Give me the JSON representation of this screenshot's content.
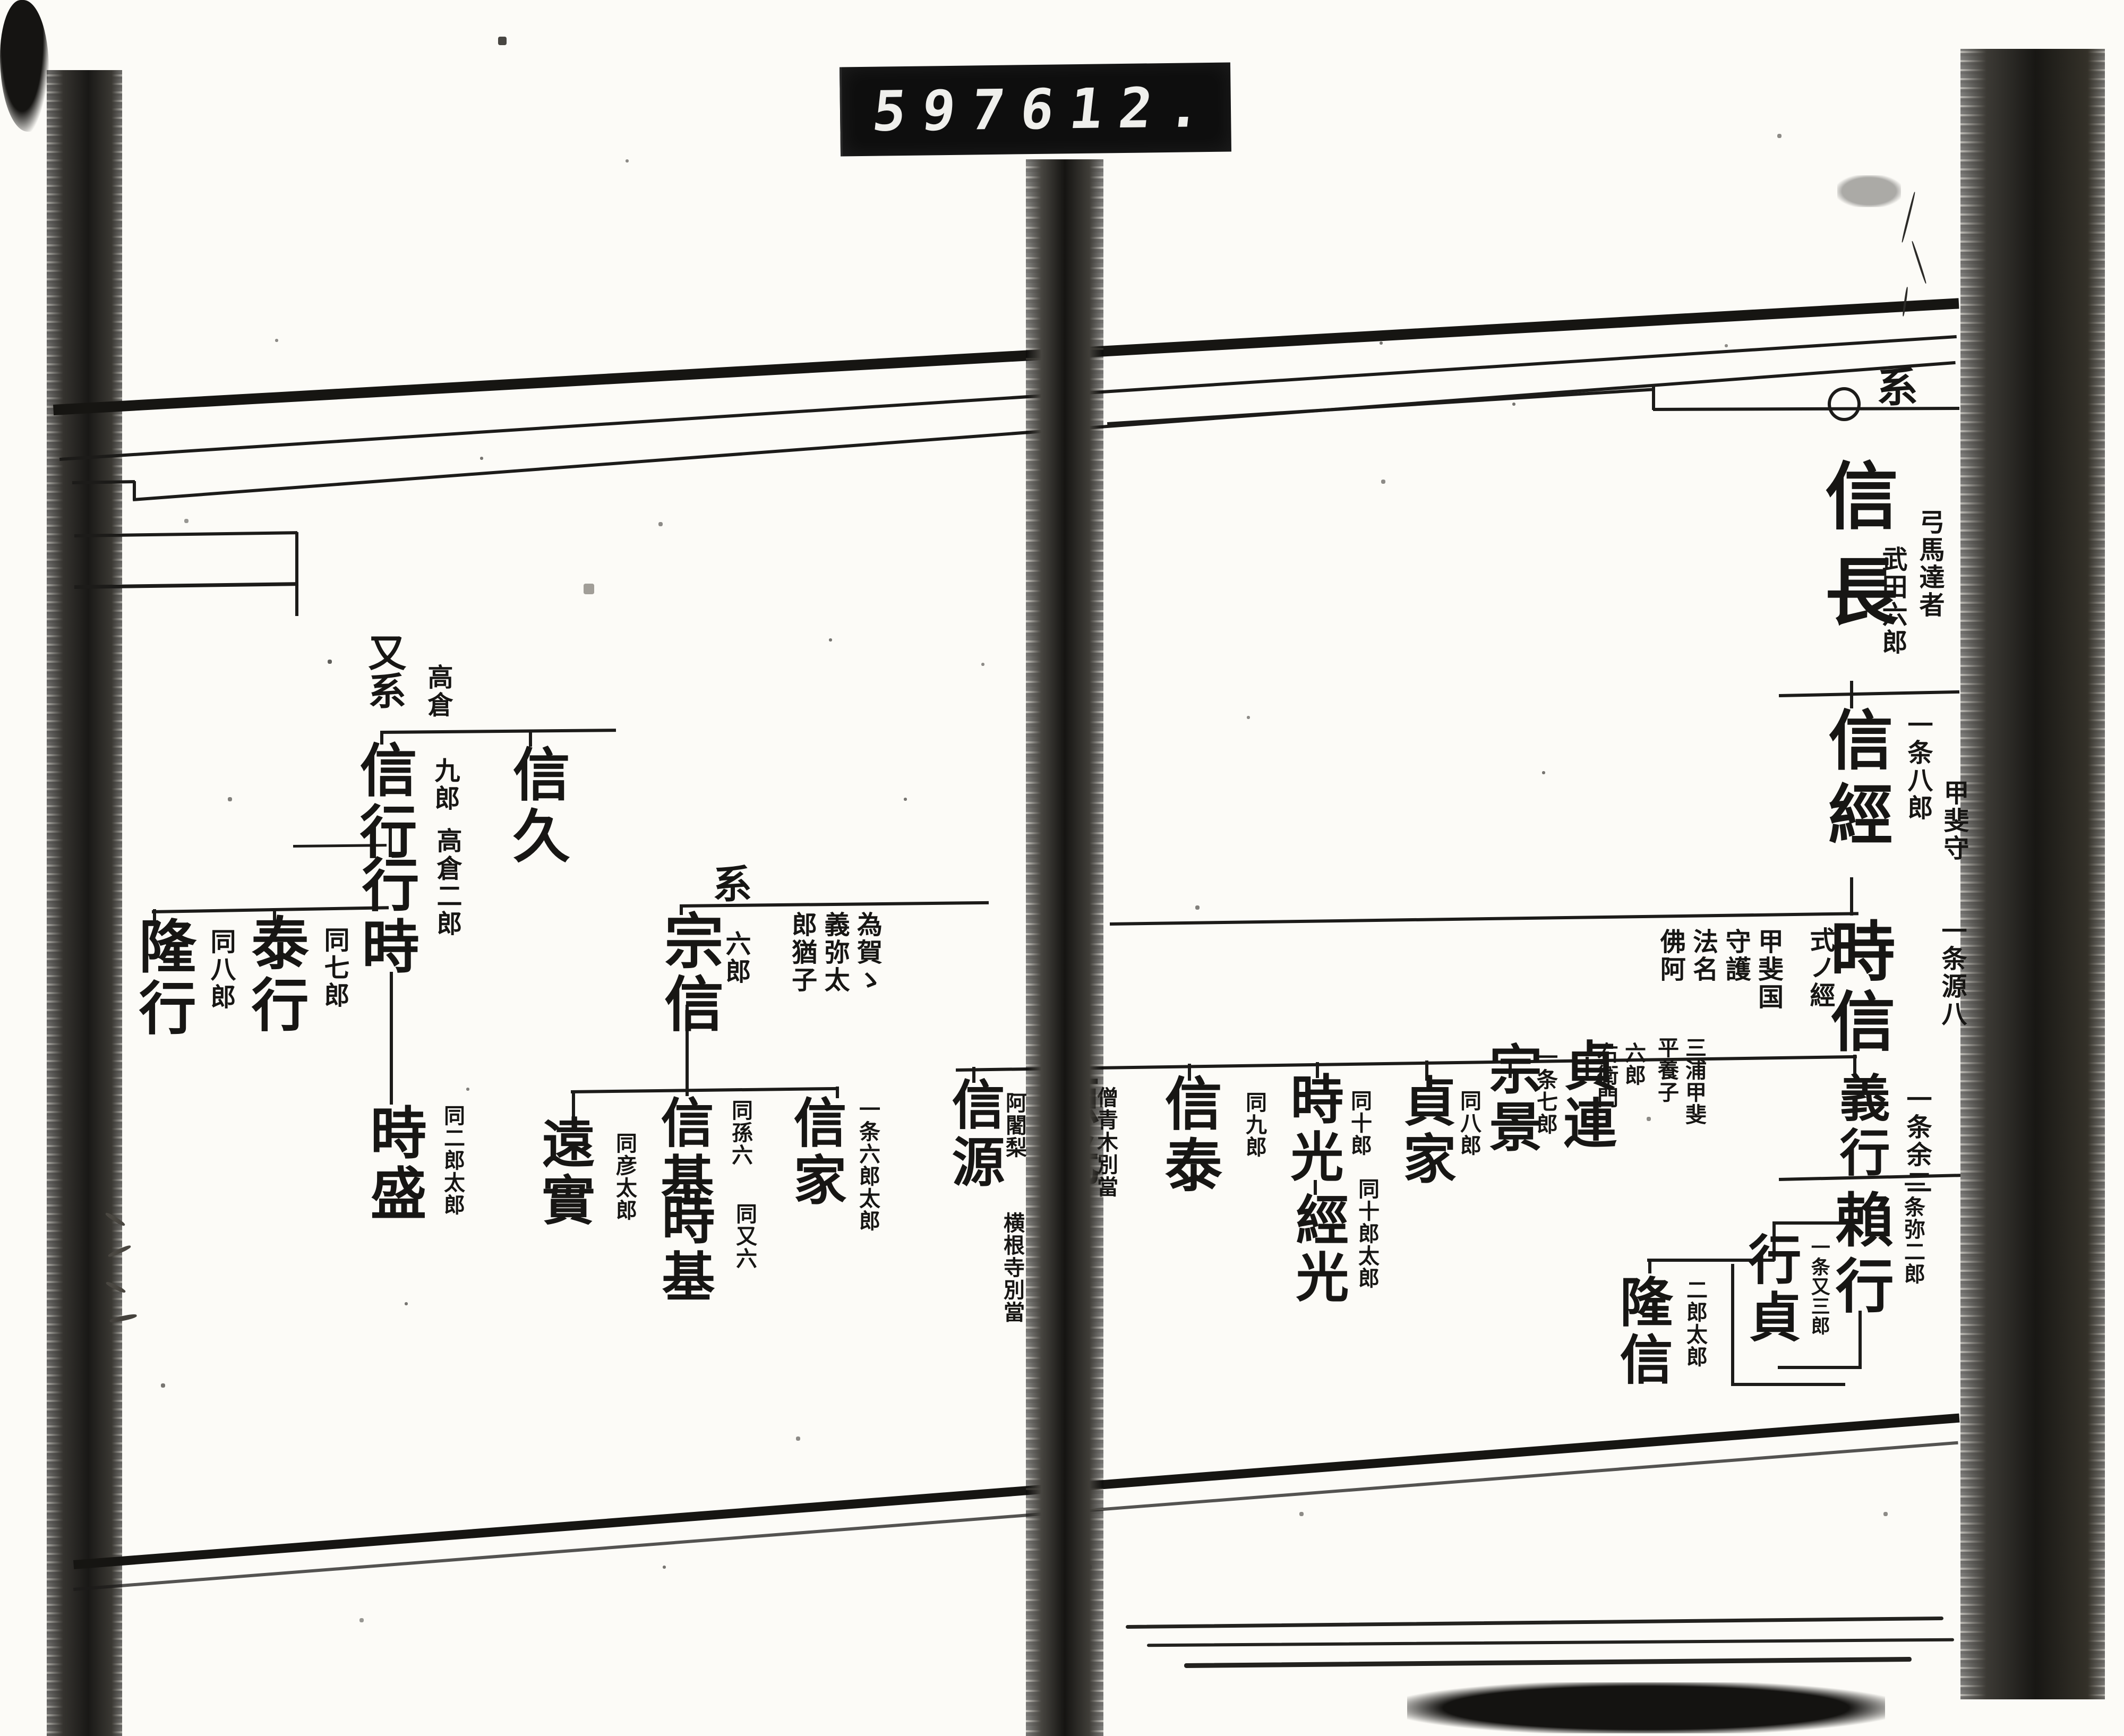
{
  "counter": {
    "left_digits": "597",
    "right_digits": "612."
  },
  "right_page": {
    "continuation_marker": "系",
    "origin_symbol": "circle",
    "main_line": {
      "g1": {
        "name": "信長",
        "note_outer": "弓馬達者",
        "note_inner": "武田六郎"
      },
      "g2": {
        "name": "信經",
        "note_right": "一条八郎"
      },
      "g3": {
        "name": "時信",
        "note_right_upper": "甲斐守",
        "note_right_lower": "一条源八",
        "note_left_first": "式ノ經",
        "note_left_block": "甲斐国\n守護\n法名\n佛阿"
      },
      "g4": {
        "name": "義行",
        "note_right": "一条余二"
      },
      "g5": {
        "name": "賴行",
        "note_right": "一条弥二郎"
      }
    },
    "tokinobu_children": {
      "c1": {
        "name": "貞連",
        "note_near": "六郎\n右衛門",
        "note_far": "三浦甲斐\n平養子"
      },
      "c2": {
        "name": "宗景",
        "note": "一条七郎"
      },
      "c3": {
        "name": "貞家",
        "note": "同八郎"
      },
      "c4": {
        "name": "時光",
        "note": "同十郎"
      },
      "c4_son": {
        "name": "經光",
        "note": "同十郎太郎"
      },
      "c5": {
        "name": "信泰",
        "note": "同九郎"
      },
      "c6": {
        "name": "源光",
        "note": "僧青木別當"
      },
      "c7": {
        "name": "信源",
        "note_right": "阿闍梨",
        "note_below": "横根寺別當"
      }
    },
    "yoriyuki_children": {
      "s1": {
        "name": "行貞",
        "note": "一条又三郎"
      },
      "s2": {
        "name": "隆信",
        "note": "二郎太郎"
      }
    }
  },
  "left_page": {
    "takakura_branch": {
      "marker": "又系",
      "marker_note": "高倉",
      "b1": {
        "name": "信久"
      },
      "b2": {
        "name": "信行",
        "note": "九郎"
      },
      "b3": {
        "name": "行時",
        "note": "高倉二郎"
      },
      "b4": {
        "name": "泰行",
        "note": "同七郎"
      },
      "b5": {
        "name": "隆行",
        "note": "同八郎"
      },
      "b6": {
        "name": "時盛",
        "note": "同二郎太郎"
      }
    },
    "munenobu_branch": {
      "marker": "系",
      "h1": {
        "name": "宗信",
        "note_near": "六郎",
        "note_far": "為賀ゝ\n義弥太\n郎猶子"
      },
      "h2": {
        "name": "信基",
        "note": "同孫六"
      },
      "h3": {
        "name": "時基",
        "note": "同又六"
      },
      "h4": {
        "name": "信家",
        "note": "一条六郎太郎"
      },
      "h5": {
        "name": "遠實",
        "note": "同彦太郎"
      }
    }
  }
}
